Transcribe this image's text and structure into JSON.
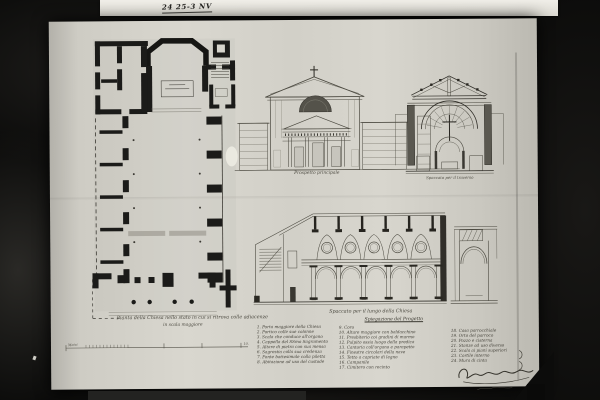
{
  "colors": {
    "photo_background": "#0b0b0a",
    "paper": "#d8d6ce",
    "top_strip_paper": "#e9e7e1",
    "ink": "#1b1b19"
  },
  "archival_note": "24 25-3 NV",
  "plan": {
    "caption_line1": "Pianta della Chiesa nello stato in cui si ritrova colle adiacenze",
    "caption_line2": "in scala maggiore"
  },
  "facade": {
    "caption": "Prospetto principale"
  },
  "transverse": {
    "caption": "Spaccato per il traverso"
  },
  "longitudinal": {
    "caption": "Spaccato per il lungo della Chiesa"
  },
  "legend": {
    "header": "Spiegazione del Progetto",
    "col1": [
      "1. Porta maggiore della Chiesa",
      "2. Portico colle sue colonne",
      "3. Scala che conduce all'organo",
      "4. Cappella del SSmo Sagramento",
      "5. Altare di pietra con sua mensa",
      "6. Sagrestia colla sua credenza",
      "7. Fonte battesimale colla piletta",
      "8. Abitazione ad uso del custode"
    ],
    "col2": [
      "9. Coro",
      "10. Altare maggiore con baldacchino",
      "11. Presbiterio coi gradini di marmo",
      "12. Pulpito ossia luogo della predica",
      "13. Cantoria coll'organo e parapetto",
      "14. Finestre circolari della nave",
      "15. Tetto a capriate di legno",
      "16. Campanile",
      "17. Cimitero con recinto"
    ],
    "col3": [
      "18. Casa parrocchiale",
      "19. Orto del parroco",
      "20. Pozzo e cisterna",
      "21. Stanze ad uso diverso",
      "22. Scala ai piani superiori",
      "23. Cortile interno",
      "24. Mura di cinta"
    ]
  },
  "scale_bar": {
    "label": "Metri",
    "end_value": "10."
  }
}
